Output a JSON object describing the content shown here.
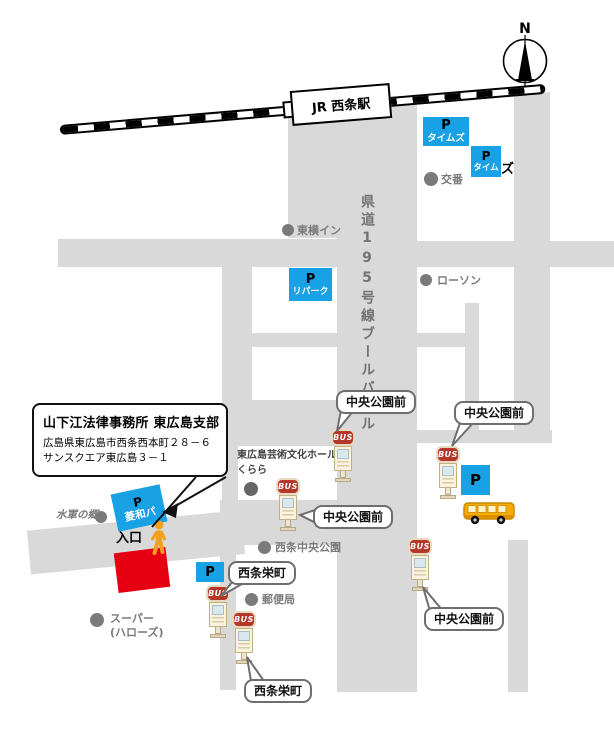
{
  "colors": {
    "road_gray": "#d9d9d9",
    "parking_blue": "#19a1e5",
    "building_red": "#e60012",
    "poi_gray": "#7a7a7a",
    "bus_sign_red": "#b5372a",
    "person_orange": "#f5a01e"
  },
  "compass": {
    "label": "N"
  },
  "railway": {
    "station_label": "JR 西条駅"
  },
  "boulevard_label": "県道195号線ブールバール",
  "office": {
    "title": "山下江法律事務所 東広島支部",
    "address1": "広島県東広島市西条西本町２８－６",
    "address2": "サンスクエア東広島３－１",
    "entrance_label": "入口"
  },
  "parkings": {
    "times1": {
      "symbol": "P",
      "name": "タイムズ"
    },
    "times2": {
      "symbol": "P",
      "name": "タイム",
      "name_overflow": "ズ"
    },
    "repark": {
      "symbol": "P",
      "name": "リパーク"
    },
    "ryowa": {
      "symbol": "P",
      "name": "菱和パ"
    },
    "sakaemachi": {
      "symbol": "P"
    },
    "chuo": {
      "symbol": "P"
    }
  },
  "pois": {
    "koban": "交番",
    "toyoko_inn": "東横イン",
    "lawson": "ローソン",
    "suigun": "水軍の郷",
    "supermarket_line1": "スーパー",
    "supermarket_line2": "(ハローズ)",
    "hall_line1": "東広島芸術文化ホール",
    "hall_line2": "くらら",
    "chuo_park": "西条中央公園",
    "post_office": "郵便局"
  },
  "bus": {
    "sign_label": "BUS"
  },
  "callouts": {
    "chuo_koen_mae": "中央公園前",
    "saijo_sakaemachi": "西条栄町"
  }
}
